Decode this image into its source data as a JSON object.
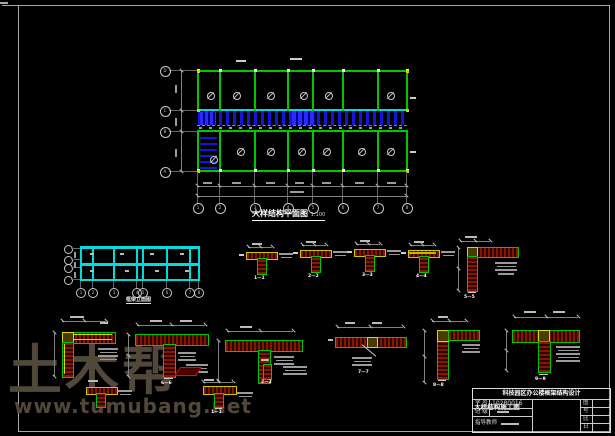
{
  "page": {
    "type": "cad-structural-drawing",
    "background": "#000000"
  },
  "watermark": {
    "text": "土木帮",
    "url": "www.tumubang.net",
    "color": "#52483a"
  },
  "colors": {
    "grid_green": "#00c800",
    "axis_cyan": "#00dcdc",
    "hatch_blue": "#1616d8",
    "rebar_fill_red": "#8a1400",
    "outline_red": "#e01000",
    "accent_yellow": "#d9d900",
    "dim_gray": "#9a9a9a",
    "text_white": "#ffffff",
    "frame_gray": "#a8a8a8"
  },
  "plan": {
    "title": "大样结构平面图",
    "scale": "1:100",
    "bottom_axes": [
      "1",
      "2",
      "3",
      "4",
      "5",
      "6",
      "7",
      "8"
    ],
    "left_axes": [
      "D",
      "C",
      "B",
      "A"
    ]
  },
  "elevation": {
    "title": "框架立面图",
    "bottom_axes": [
      "1",
      "2",
      "3",
      "4",
      "5",
      "6",
      "7",
      "8"
    ]
  },
  "details": {
    "labels": {
      "d1": "1—1",
      "d2": "2—2",
      "d3": "3—3",
      "d4": "4—4",
      "corner": "5—5",
      "t2": "6—6",
      "b4": "7—7",
      "c5": "8—8",
      "t6": "9—9",
      "s2": "1—1",
      "s3": "2—2"
    }
  },
  "titleblock": {
    "header": "科技园区办公楼框架结构设计",
    "drawing_name": "大样结构施工图",
    "fields": [
      {
        "label": "学 号",
        "value": "10280016"
      },
      {
        "label": "班 级",
        "value": ""
      },
      {
        "label": "指导教师",
        "value": ""
      }
    ],
    "right_labels": [
      "图",
      "号",
      "比",
      "日"
    ]
  }
}
